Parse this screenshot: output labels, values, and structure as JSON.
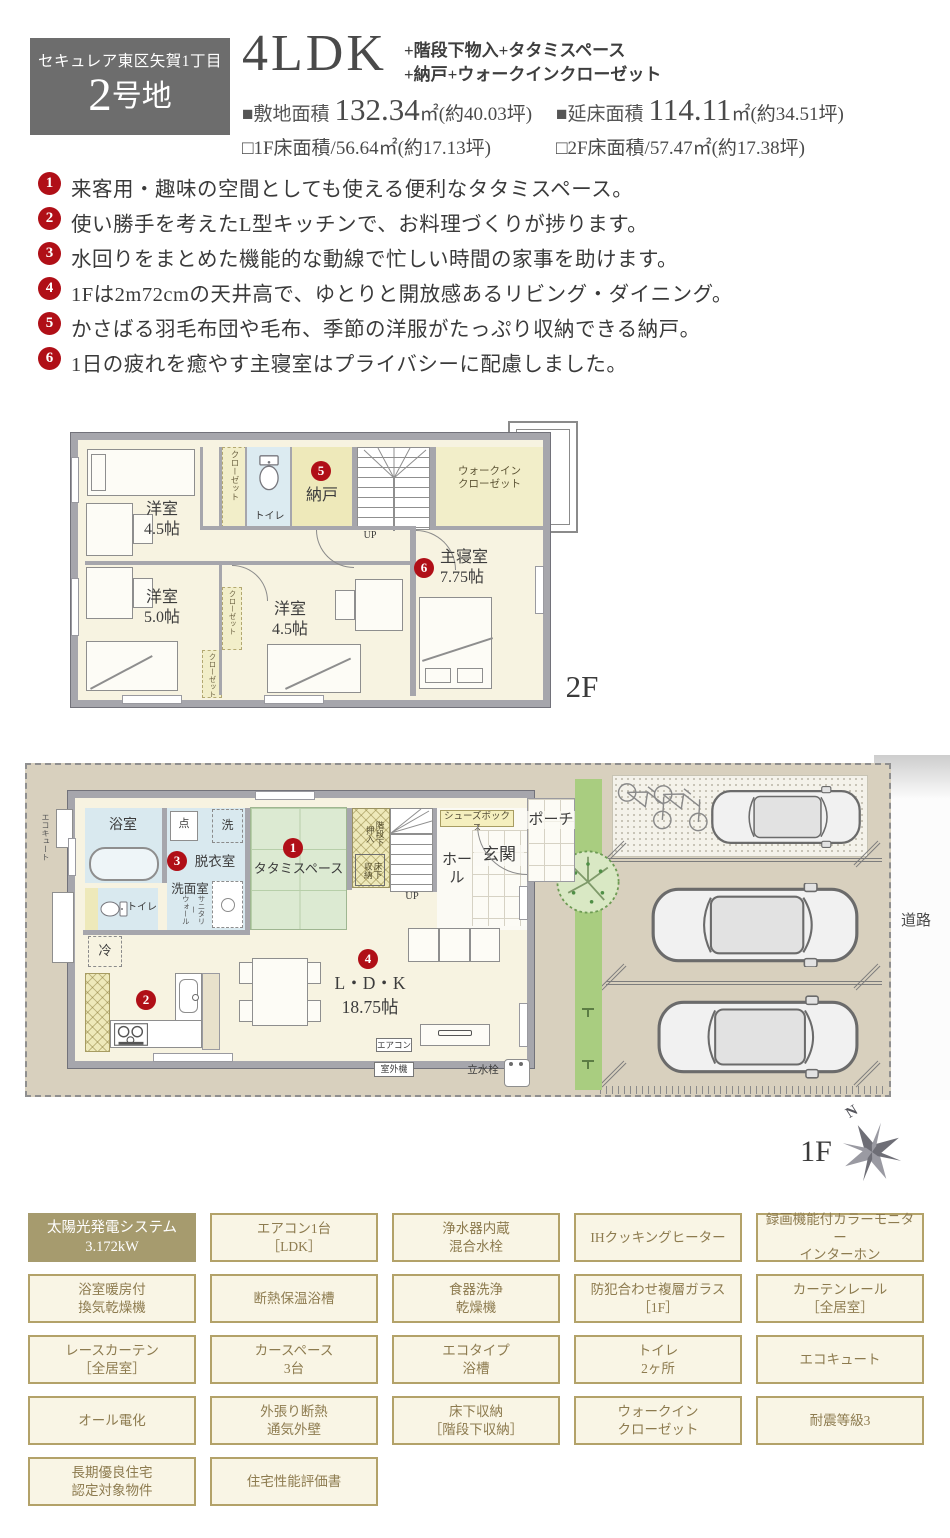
{
  "header": {
    "location": "セキュレア東区矢賀1丁目",
    "lot_big": "2",
    "lot_suffix": "号地",
    "plan_type": "4LDK",
    "extras1": "+階段下物入+タタミスペース",
    "extras2": "+納戸+ウォークインクローゼット",
    "site_area": {
      "label": "■敷地面積",
      "value": "132.34",
      "unit": "㎡(約40.03坪)"
    },
    "total_area": {
      "label": "■延床面積",
      "value": "114.11",
      "unit": "㎡(約34.51坪)"
    },
    "f1_area": "□1F床面積/56.64㎡(約17.13坪)",
    "f2_area": "□2F床面積/57.47㎡(約17.38坪)"
  },
  "bullets": [
    {
      "num": "1",
      "text": "来客用・趣味の空間としても使える便利なタタミスペース。"
    },
    {
      "num": "2",
      "text": "使い勝手を考えたL型キッチンで、お料理づくりが捗ります。"
    },
    {
      "num": "3",
      "text": "水回りをまとめた機能的な動線で忙しい時間の家事を助けます。"
    },
    {
      "num": "4",
      "text": "1Fは2m72cmの天井高で、ゆとりと開放感あるリビング・ダイニング。"
    },
    {
      "num": "5",
      "text": "かさばる羽毛布団や毛布、季節の洋服がたっぷり収納できる納戸。"
    },
    {
      "num": "6",
      "text": "1日の疲れを癒やす主寝室はプライバシーに配慮しました。"
    }
  ],
  "floor2": {
    "floor_label": "2F",
    "rooms": {
      "yoshitsu_a": "洋室\n4.5帖",
      "yoshitsu_b": "洋室\n5.0帖",
      "yoshitsu_c": "洋室\n4.5帖",
      "toilet": "トイレ",
      "nando": "納戸",
      "wic": "ウォークイン\nクローゼット",
      "master": "主寝室\n7.75帖",
      "closet1": "クローゼット",
      "closet2": "クローゼット",
      "closet3": "クローゼット",
      "up": "UP"
    },
    "badges": {
      "nando": "5",
      "master": "6"
    }
  },
  "floor1": {
    "floor_label": "1F",
    "rooms": {
      "bath": "浴室",
      "datsui": "脱衣室",
      "senmen": "洗面室",
      "sanitary_wall": "サニタリー\nウォール",
      "inspection": "点",
      "laundry": "洗",
      "toilet": "トイレ",
      "rei": "冷",
      "tatami": "タタミスペース",
      "kaidan_oshiire": "階段下\n押入",
      "yukashita": "床下\n収納",
      "up": "UP",
      "hall": "ホール",
      "shoes": "シューズボックス",
      "genkan": "玄関",
      "porch": "ポーチ",
      "ldk": "L・D・K\n18.75帖",
      "ecocute": "エコキュート",
      "aircon": "エアコン",
      "outdoor": "室外機",
      "faucet": "立水栓",
      "road": "道路",
      "north": "N"
    },
    "badges": {
      "tatami": "1",
      "kitchen": "2",
      "datsui": "3",
      "ldk": "4"
    }
  },
  "features": {
    "items": [
      {
        "text": "太陽光発電システム\n3.172kW",
        "highlight": true
      },
      {
        "text": "エアコン1台\n［LDK］"
      },
      {
        "text": "浄水器内蔵\n混合水栓"
      },
      {
        "text": "IHクッキングヒーター"
      },
      {
        "text": "録画機能付カラーモニター\nインターホン"
      },
      {
        "text": "浴室暖房付\n換気乾燥機"
      },
      {
        "text": "断熱保温浴槽"
      },
      {
        "text": "食器洗浄\n乾燥機"
      },
      {
        "text": "防犯合わせ複層ガラス\n［1F］"
      },
      {
        "text": "カーテンレール\n［全居室］"
      },
      {
        "text": "レースカーテン\n［全居室］"
      },
      {
        "text": "カースペース\n3台"
      },
      {
        "text": "エコタイプ\n浴槽"
      },
      {
        "text": "トイレ\n2ヶ所"
      },
      {
        "text": "エコキュート"
      },
      {
        "text": "オール電化"
      },
      {
        "text": "外張り断熱\n通気外壁"
      },
      {
        "text": "床下収納\n［階段下収納］"
      },
      {
        "text": "ウォークイン\nクローゼット"
      },
      {
        "text": "耐震等級3"
      },
      {
        "text": "長期優良住宅\n認定対象物件"
      },
      {
        "text": "住宅性能評価書"
      }
    ]
  }
}
